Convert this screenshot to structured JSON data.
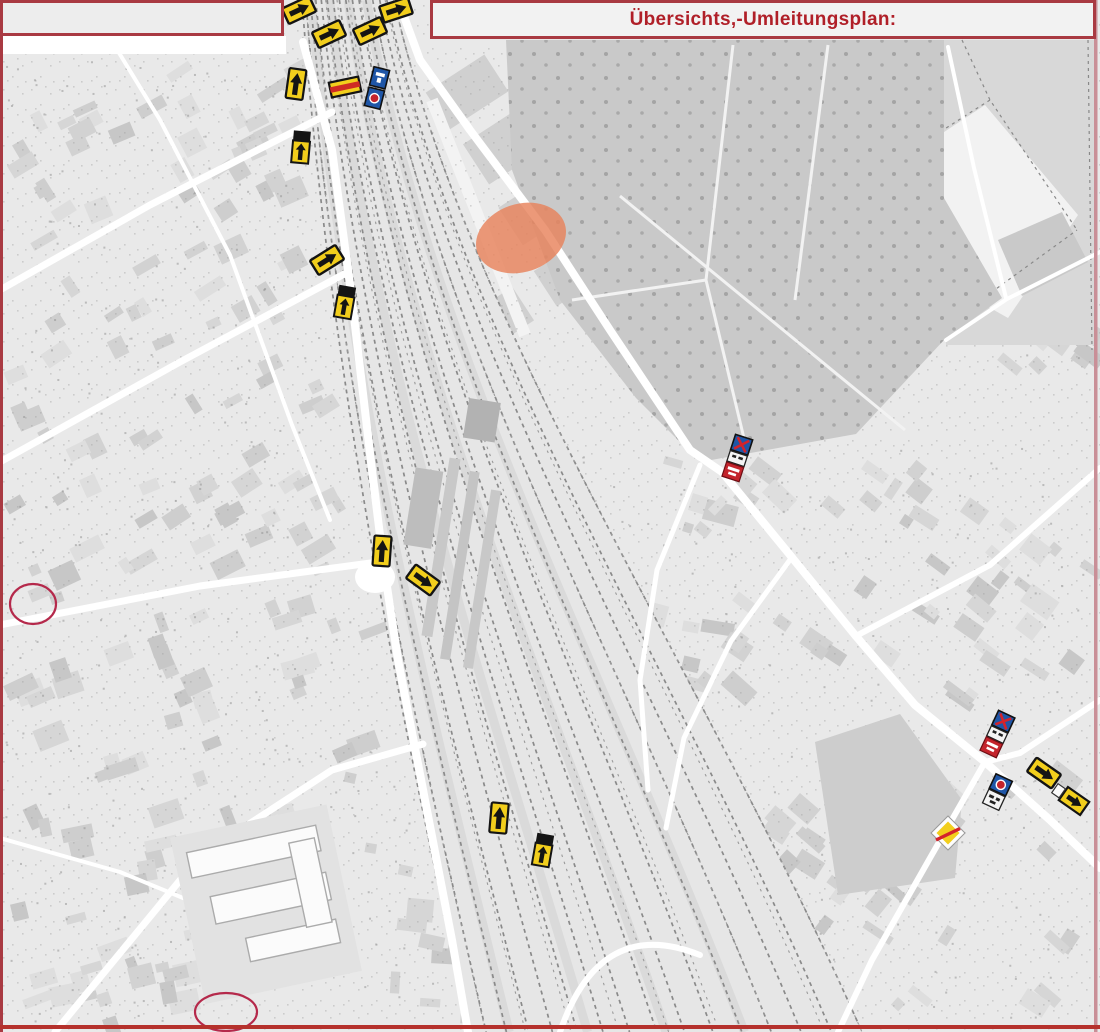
{
  "header": {
    "title": "Übersichts,-Umleitungsplan:"
  },
  "colors": {
    "border_red": "#a93a42",
    "title_red": "#b01f28",
    "bottom_line_red": "#b5312c",
    "right_line_pink": "#c98f97",
    "sign_yellow": "#f2ce1c",
    "sign_blue": "#1f56a7",
    "sign_red": "#c4242c",
    "highlight_orange": "#e8835c",
    "marker_red": "#b5294b",
    "map_background": "#e9e9e9"
  },
  "map": {
    "construction_highlight": {
      "cx": 521,
      "cy": 238,
      "rx": 46,
      "ry": 34,
      "rotation": -18
    },
    "marker_circles": [
      {
        "cx": 33,
        "cy": 604,
        "rx": 23,
        "ry": 20
      },
      {
        "cx": 226,
        "cy": 1012,
        "rx": 31,
        "ry": 19
      }
    ],
    "traffic_signs": [
      {
        "type": "detour-arrow-h",
        "x": 299,
        "y": 10,
        "rot": -25
      },
      {
        "type": "detour-arrow-h",
        "x": 396,
        "y": 10,
        "rot": -18
      },
      {
        "type": "detour-arrow-h",
        "x": 329,
        "y": 34,
        "rot": -25
      },
      {
        "type": "detour-arrow-h",
        "x": 370,
        "y": 31,
        "rot": -25
      },
      {
        "type": "detour-arrow-v",
        "x": 296,
        "y": 84,
        "rot": 8
      },
      {
        "type": "detour-crossed",
        "x": 345,
        "y": 87,
        "rot": -12
      },
      {
        "type": "no-stopping-combo",
        "x": 377,
        "y": 88,
        "rot": 14
      },
      {
        "type": "detour-arrow-top-bar",
        "x": 301,
        "y": 147,
        "rot": 5
      },
      {
        "type": "detour-arrow-h",
        "x": 327,
        "y": 260,
        "rot": -32
      },
      {
        "type": "detour-arrow-top-bar",
        "x": 345,
        "y": 302,
        "rot": 10
      },
      {
        "type": "detour-arrow-v",
        "x": 382,
        "y": 551,
        "rot": 4
      },
      {
        "type": "detour-arrow-h",
        "x": 423,
        "y": 580,
        "rot": 36
      },
      {
        "type": "no-stopping-red-combo",
        "x": 737,
        "y": 459,
        "rot": 18
      },
      {
        "type": "detour-arrow-v",
        "x": 499,
        "y": 818,
        "rot": 5
      },
      {
        "type": "detour-arrow-top-bar",
        "x": 543,
        "y": 850,
        "rot": 10
      },
      {
        "type": "no-stopping-red-combo",
        "x": 997,
        "y": 735,
        "rot": 25
      },
      {
        "type": "detour-arrow-h",
        "x": 1044,
        "y": 773,
        "rot": 35
      },
      {
        "type": "no-stopping-white-combo",
        "x": 997,
        "y": 793,
        "rot": 25
      },
      {
        "type": "detour-arrow-panel",
        "x": 1074,
        "y": 801,
        "rot": 35
      },
      {
        "type": "priority-road-end",
        "x": 948,
        "y": 833,
        "rot": 0
      }
    ]
  }
}
